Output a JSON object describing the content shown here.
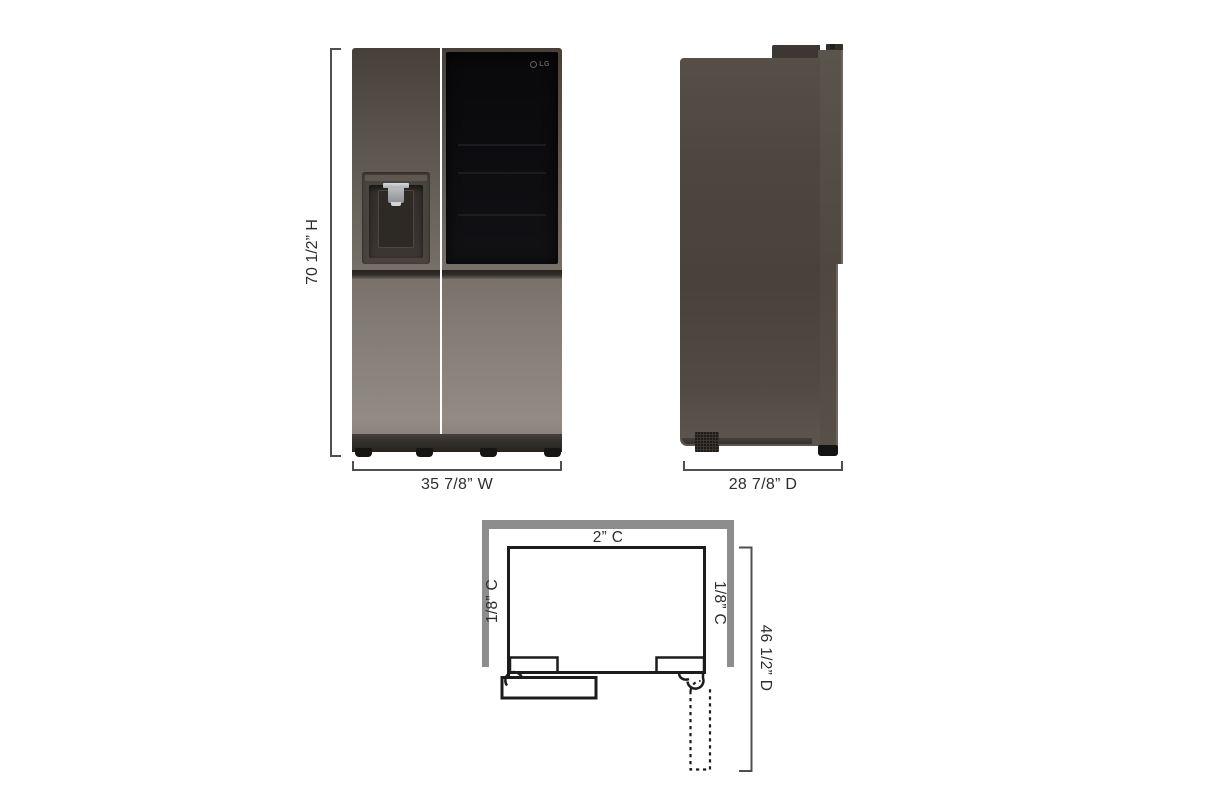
{
  "front_view": {
    "height_label": "70 1/2” H",
    "width_label": "35 7/8” W",
    "brand": "LG"
  },
  "side_view": {
    "depth_label": "28 7/8” D"
  },
  "plan_view": {
    "top_clearance_label": "2” C",
    "left_clearance_label": "1/8” C",
    "right_clearance_label": "1/8” C",
    "depth_label": "46 1/2” D"
  },
  "icons": {
    "lg_emblem": "lg-emblem-icon",
    "dispenser_nozzle": "dispenser-nozzle-icon",
    "vent": "vent-grille-icon"
  },
  "colors": {
    "background": "#ffffff",
    "cabinet_dark": "#474039",
    "cabinet_light": "#928a83",
    "glass_panel": "#0c0c0e",
    "wall_gray": "#8d8d8d",
    "outline_black": "#1c1c1c",
    "dimension_line": "#4f4f4f",
    "label_text": "#2d2d2d",
    "chrome": "#c6c8ca"
  }
}
